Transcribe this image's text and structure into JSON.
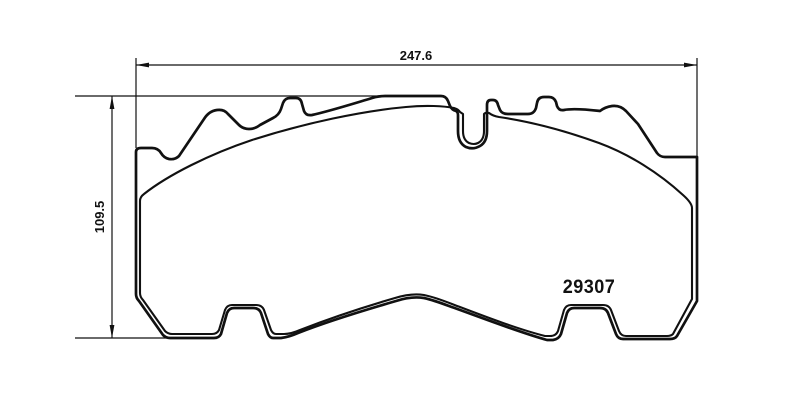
{
  "drawing": {
    "type": "technical-drawing",
    "subject": "brake-pad-outline",
    "width_dimension_label": "247.6",
    "height_dimension_label": "109.5",
    "part_number": "29307"
  },
  "colors": {
    "line": "#111111",
    "background": "#ffffff"
  }
}
